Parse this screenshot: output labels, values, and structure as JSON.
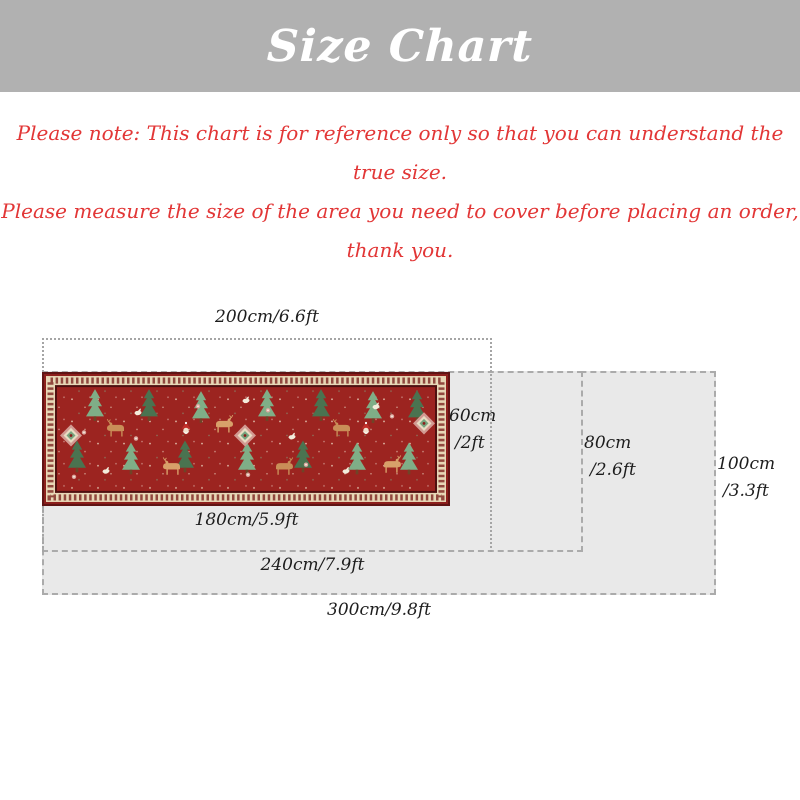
{
  "header": {
    "title": "Size Chart"
  },
  "note": {
    "line1": "Please note: This chart is for reference only so that you can understand the true size.",
    "line2": "Please measure the size of the area you need to cover before placing an order, thank you."
  },
  "diagram": {
    "outline_200": {
      "width_label": "200cm/6.6ft"
    },
    "rug": {
      "width_label": "180cm/5.9ft",
      "height_cm": "60cm",
      "height_ft": "/2ft"
    },
    "box_240": {
      "width_label": "240cm/7.9ft",
      "height_cm": "80cm",
      "height_ft": "/2.6ft"
    },
    "box_300": {
      "width_label": "300cm/9.8ft",
      "height_cm": "100cm",
      "height_ft": "/3.3ft"
    }
  },
  "colors": {
    "header_bg": "#b1b1b1",
    "header_text": "#ffffff",
    "note_text": "#e23636",
    "box_fill": "#e9e9e9",
    "box_border": "#ababab",
    "outline_border": "#a5a5a5",
    "label_text": "#1d1d1d",
    "rug_field": "#9c2420",
    "rug_border_cream": "#e7d7b6",
    "rug_outer": "#5f1414"
  }
}
